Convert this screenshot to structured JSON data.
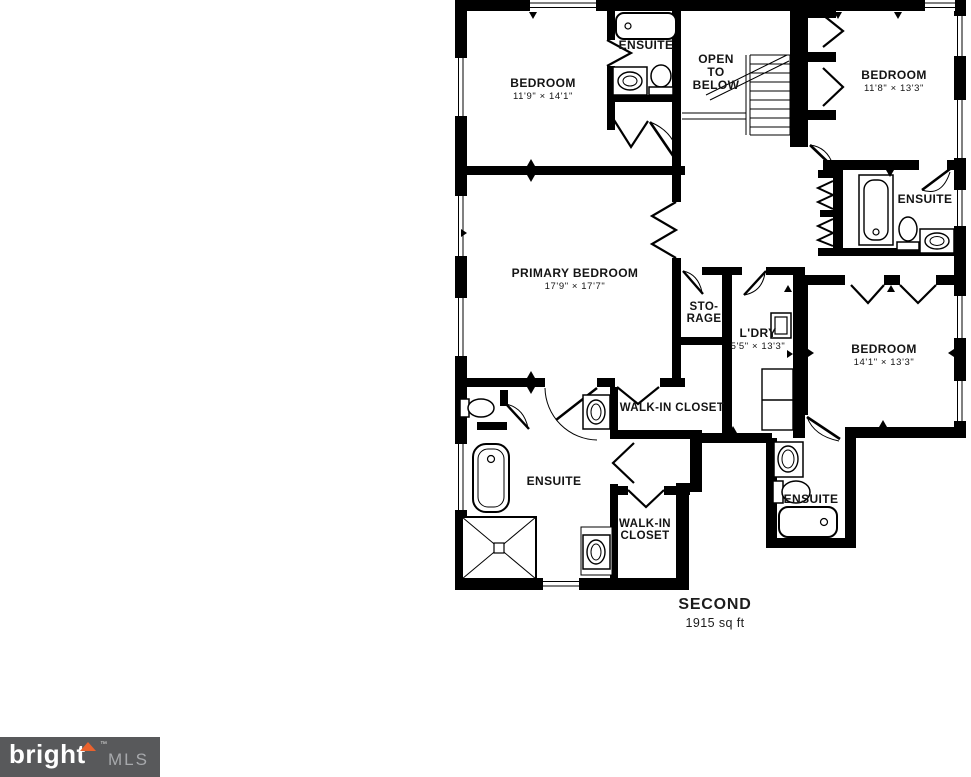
{
  "floorplan": {
    "rooms": [
      {
        "id": "bedroom-top-left",
        "lines": [
          "BEDROOM",
          "11'9\" × 14'1\""
        ]
      },
      {
        "id": "ensuite-top",
        "lines": [
          "ENSUITE"
        ]
      },
      {
        "id": "open-to-below",
        "lines": [
          "OPEN",
          "TO",
          "BELOW"
        ]
      },
      {
        "id": "bedroom-top-right",
        "lines": [
          "BEDROOM",
          "11'8\" × 13'3\""
        ]
      },
      {
        "id": "ensuite-right",
        "lines": [
          "ENSUITE"
        ]
      },
      {
        "id": "primary-bedroom",
        "lines": [
          "PRIMARY BEDROOM",
          "17'9\" × 17'7\""
        ]
      },
      {
        "id": "storage",
        "lines": [
          "STO-",
          "RAGE"
        ]
      },
      {
        "id": "laundry",
        "lines": [
          "L'DRY",
          "5'5\" × 13'3\""
        ]
      },
      {
        "id": "bedroom-right",
        "lines": [
          "BEDROOM",
          "14'1\" × 13'3\""
        ]
      },
      {
        "id": "walk-in-closet-top",
        "lines": [
          "WALK-IN CLOSET"
        ]
      },
      {
        "id": "ensuite-primary",
        "lines": [
          "ENSUITE"
        ]
      },
      {
        "id": "walk-in-closet-bottom",
        "lines": [
          "WALK-IN",
          "CLOSET"
        ]
      },
      {
        "id": "ensuite-bottom",
        "lines": [
          "ENSUITE"
        ]
      }
    ],
    "floor": {
      "name": "SECOND",
      "area": "1915 sq ft"
    }
  },
  "logo": {
    "brand": "bright",
    "tm": "™",
    "suffix": "MLS",
    "bg": "#58595b",
    "accent": "#e9622e",
    "suffix_color": "#a7a9ac"
  },
  "colors": {
    "walls": "#000000",
    "background": "#ffffff"
  }
}
